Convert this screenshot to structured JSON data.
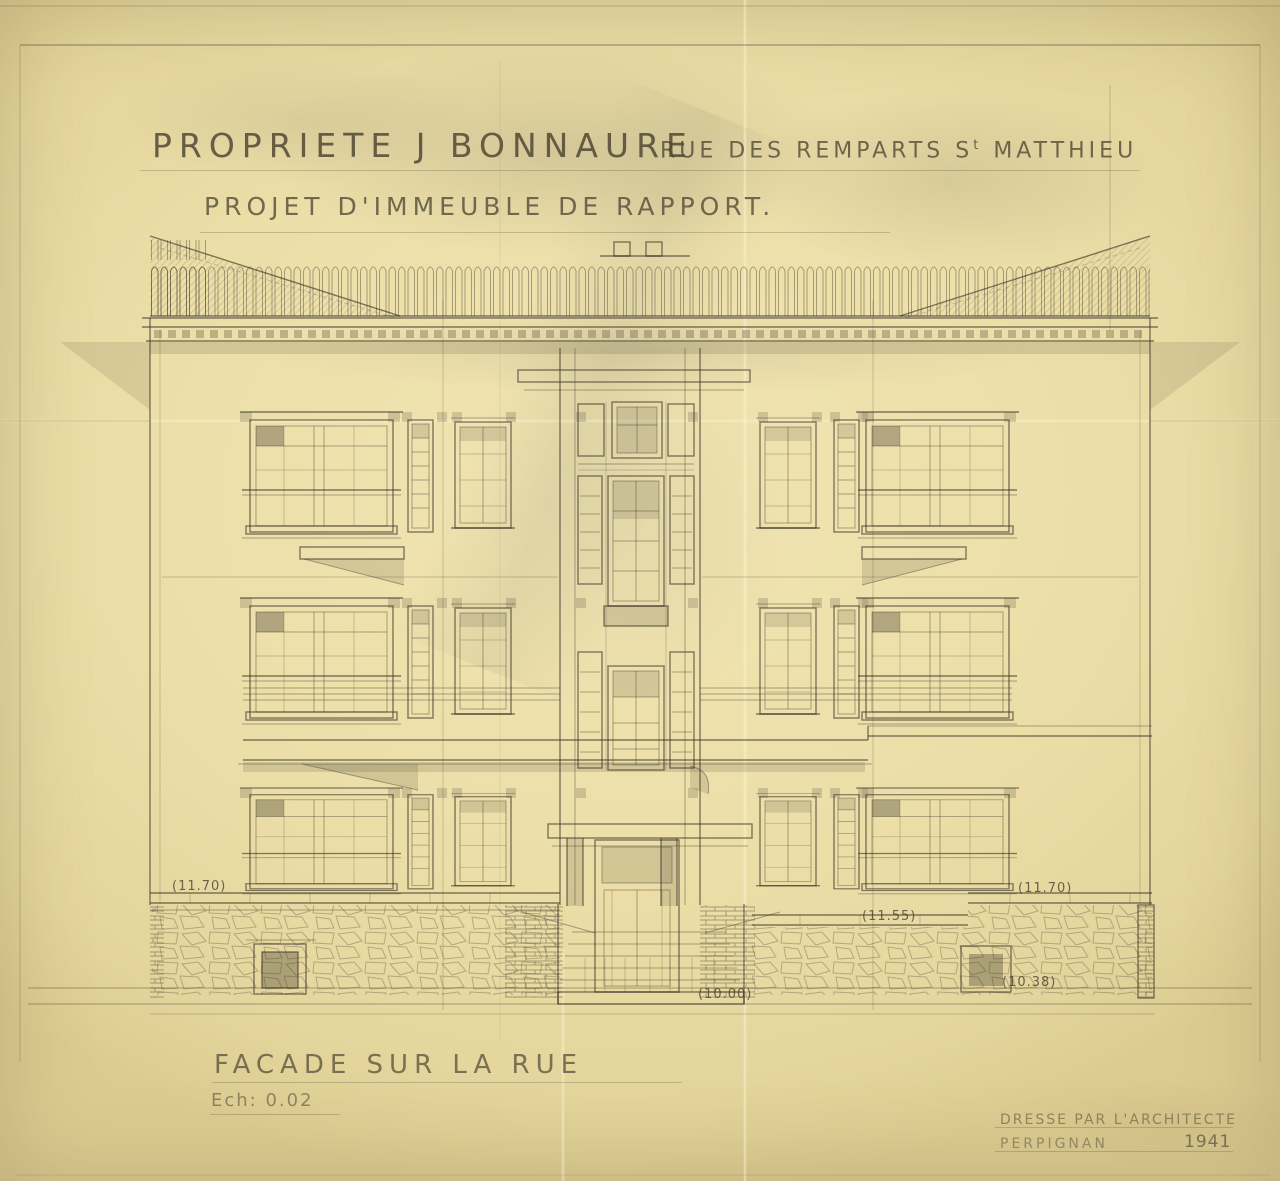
{
  "sheet": {
    "title_property": "PROPRIETE J BONNAURE",
    "title_street_pre": "RUE DES REMPARTS S",
    "title_street_sup": "t",
    "title_street_post": " MATTHIEU",
    "title_project": "PROJET D'IMMEUBLE DE RAPPORT.",
    "caption": "FACADE SUR LA RUE",
    "scale": "Ech: 0.02",
    "stamp": {
      "line1": "DRESSE PAR L'ARCHITECTE",
      "city": "PERPIGNAN",
      "year": "1941"
    }
  },
  "dimensions": {
    "left_parapet": "(11.70)",
    "mid_right_parapet": "(11.55)",
    "right_parapet": "(11.70)",
    "entrance_width": "(10.00)",
    "right_base": "(10.38)"
  },
  "colors": {
    "paper": "#ecdea7",
    "pencil": "#3a3428"
  }
}
